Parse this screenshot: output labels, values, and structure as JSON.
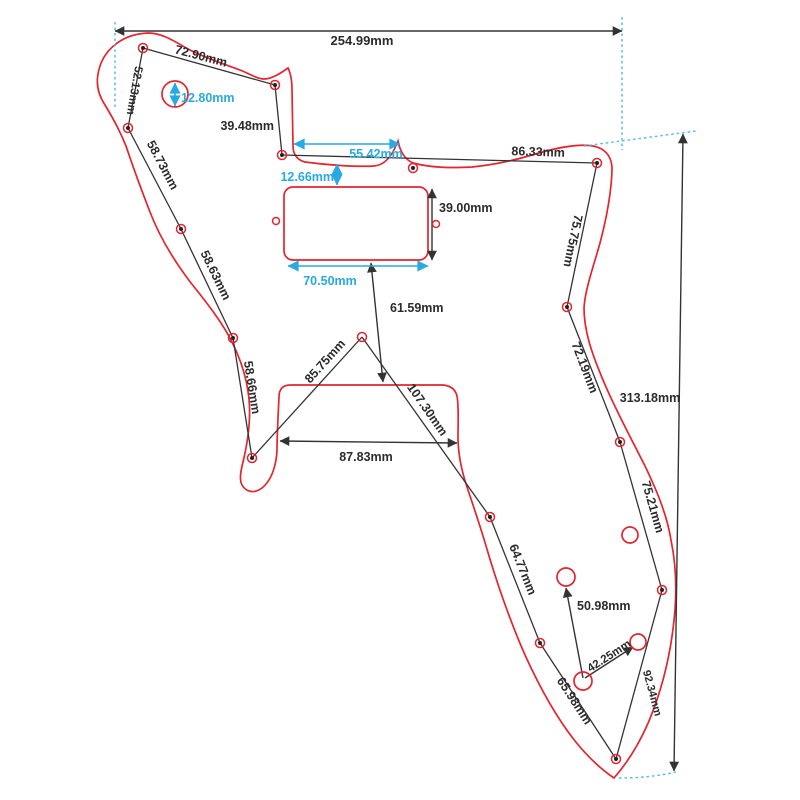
{
  "drawing": {
    "kind": "guitar pickguard dimensional drawing",
    "unit": "mm"
  },
  "colors": {
    "outline_red": "#e4242e",
    "dimension_black": "#333333",
    "dimension_cyan": "#29a9e1"
  },
  "labels": {
    "overall_width": "254.99mm",
    "overall_height": "313.18mm",
    "top_screw_span": "72.90mm",
    "upper_left_screw_span": "52.13mm",
    "notch_height": "39.48mm",
    "notch_width": "55.42mm",
    "hole_diameter": "12.80mm",
    "left_screw_span_1": "58.73mm",
    "left_screw_span_2": "58.63mm",
    "left_screw_span_3": "58.66mm",
    "upper_right_screw_span": "86.33mm",
    "right_screw_span_1": "75.75mm",
    "right_screw_span_2": "72.19mm",
    "right_screw_span_3": "75.21mm",
    "pickup_offset": "12.66mm",
    "pickup_height": "39.00mm",
    "pickup_width": "70.50mm",
    "pickup_to_bridge": "61.59mm",
    "bridge_diag_left": "85.75mm",
    "bridge_diag_right": "107.30mm",
    "bridge_width": "87.83mm",
    "lower_left_screw_span": "64.77mm",
    "lower_screw_span": "65.98mm",
    "pot_to_screw": "50.98mm",
    "pot_spacing": "42.25mm",
    "lower_right_screw_span": "92.34mm"
  }
}
